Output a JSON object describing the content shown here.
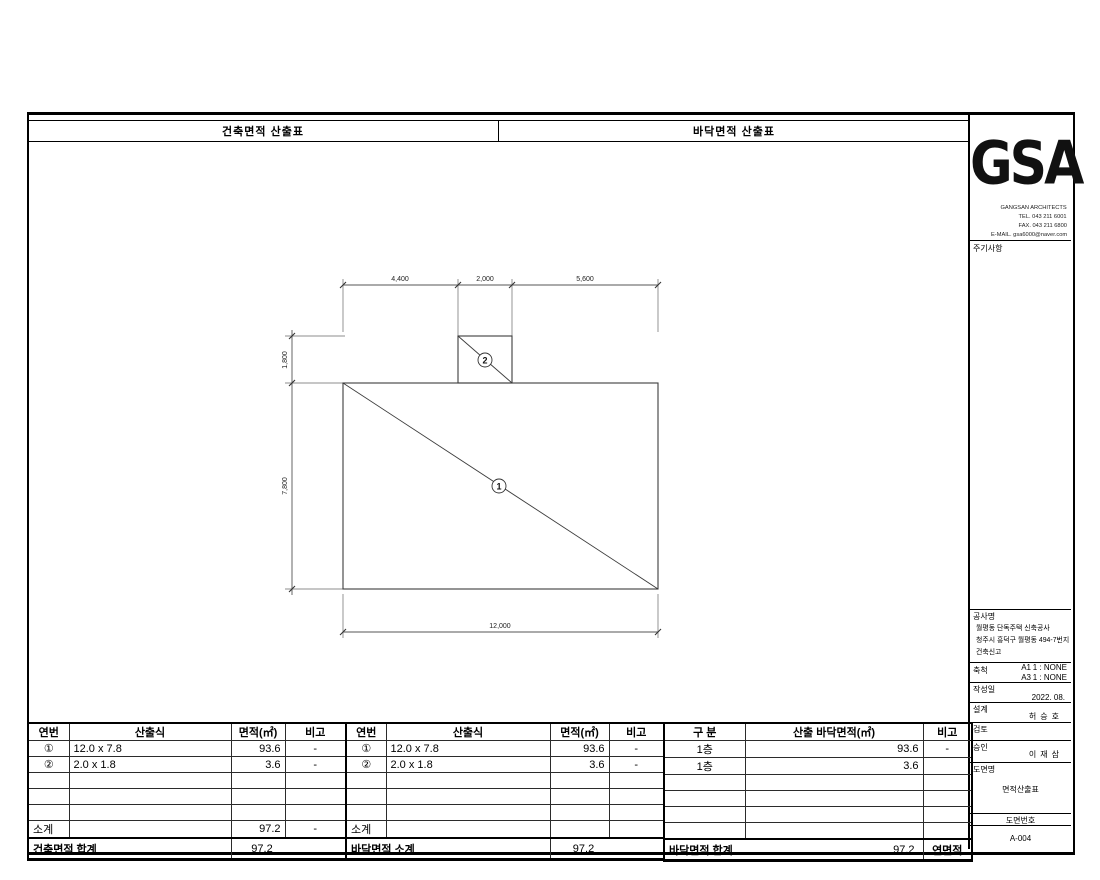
{
  "sheet": {
    "header": {
      "left": "건축면적 산출표",
      "right": "바닥면적 산출표"
    }
  },
  "title_block": {
    "logo_text": "GSA",
    "firm_name": "GANGSAN ARCHITECTS",
    "tel": "TEL. 043 211 6001",
    "fax": "FAX. 043 211 6800",
    "email": "E-MAIL. gsa6000@naver.com",
    "notes_label": "주기사항",
    "project": {
      "label": "공사명",
      "line1": "월평동 단독주택 신축공사",
      "line2": "청주시 흥덕구 월평동 494-7번지",
      "line3": "건축신고"
    },
    "scale": {
      "label": "축척",
      "a1_code": "A1",
      "a1_value": "1 : NONE",
      "a3_code": "A3",
      "a3_value": "1 : NONE"
    },
    "date": {
      "label": "작성일",
      "value": "2022. 08."
    },
    "design": {
      "label": "설계",
      "value": "허승호"
    },
    "review": {
      "label": "검토"
    },
    "approval": {
      "label": "승인",
      "value": "이재삼"
    },
    "drawing_title": {
      "label": "도면명",
      "value": "면적산출표"
    },
    "drawing_number": {
      "label": "도면번호",
      "value": "A-004"
    }
  },
  "diagram": {
    "dim_top_1": "4,400",
    "dim_top_2": "2,000",
    "dim_top_3": "5,600",
    "dim_left_1": "1,800",
    "dim_left_2": "7,800",
    "dim_bottom": "12,000",
    "mark_main": "1",
    "mark_annex": "2"
  },
  "tables": {
    "building_area": {
      "col_no": "연번",
      "col_formula": "산출식",
      "col_area": "면적(㎡)",
      "col_remark": "비고",
      "rows": [
        {
          "no": "①",
          "formula": "12.0 x 7.8",
          "area": "93.6",
          "remark": "-"
        },
        {
          "no": "②",
          "formula": "2.0 x 1.8",
          "area": "3.6",
          "remark": "-"
        }
      ],
      "subtotal": {
        "label": "소계",
        "area": "97.2",
        "remark": "-"
      },
      "total": {
        "label": "건축면적 합계",
        "area": "97.2"
      }
    },
    "floor_area": {
      "col_no": "연번",
      "col_formula": "산출식",
      "col_area": "면적(㎡)",
      "col_remark": "비고",
      "rows": [
        {
          "no": "①",
          "formula": "12.0 x 7.8",
          "area": "93.6",
          "remark": "-"
        },
        {
          "no": "②",
          "formula": "2.0 x 1.8",
          "area": "3.6",
          "remark": "-"
        }
      ],
      "subtotal": {
        "label": "소계"
      },
      "total": {
        "label": "바닥면적 소계",
        "area": "97.2"
      }
    },
    "floor_summary": {
      "col_class": "구 분",
      "col_area": "산출 바닥면적(㎡)",
      "col_remark": "비고",
      "rows": [
        {
          "class": "1층",
          "area": "93.6",
          "remark": "-"
        },
        {
          "class": "1층",
          "area": "3.6",
          "remark": ""
        }
      ],
      "total": {
        "label": "바닥면적 합계",
        "area": "97.2",
        "remark": "연면적"
      }
    }
  }
}
